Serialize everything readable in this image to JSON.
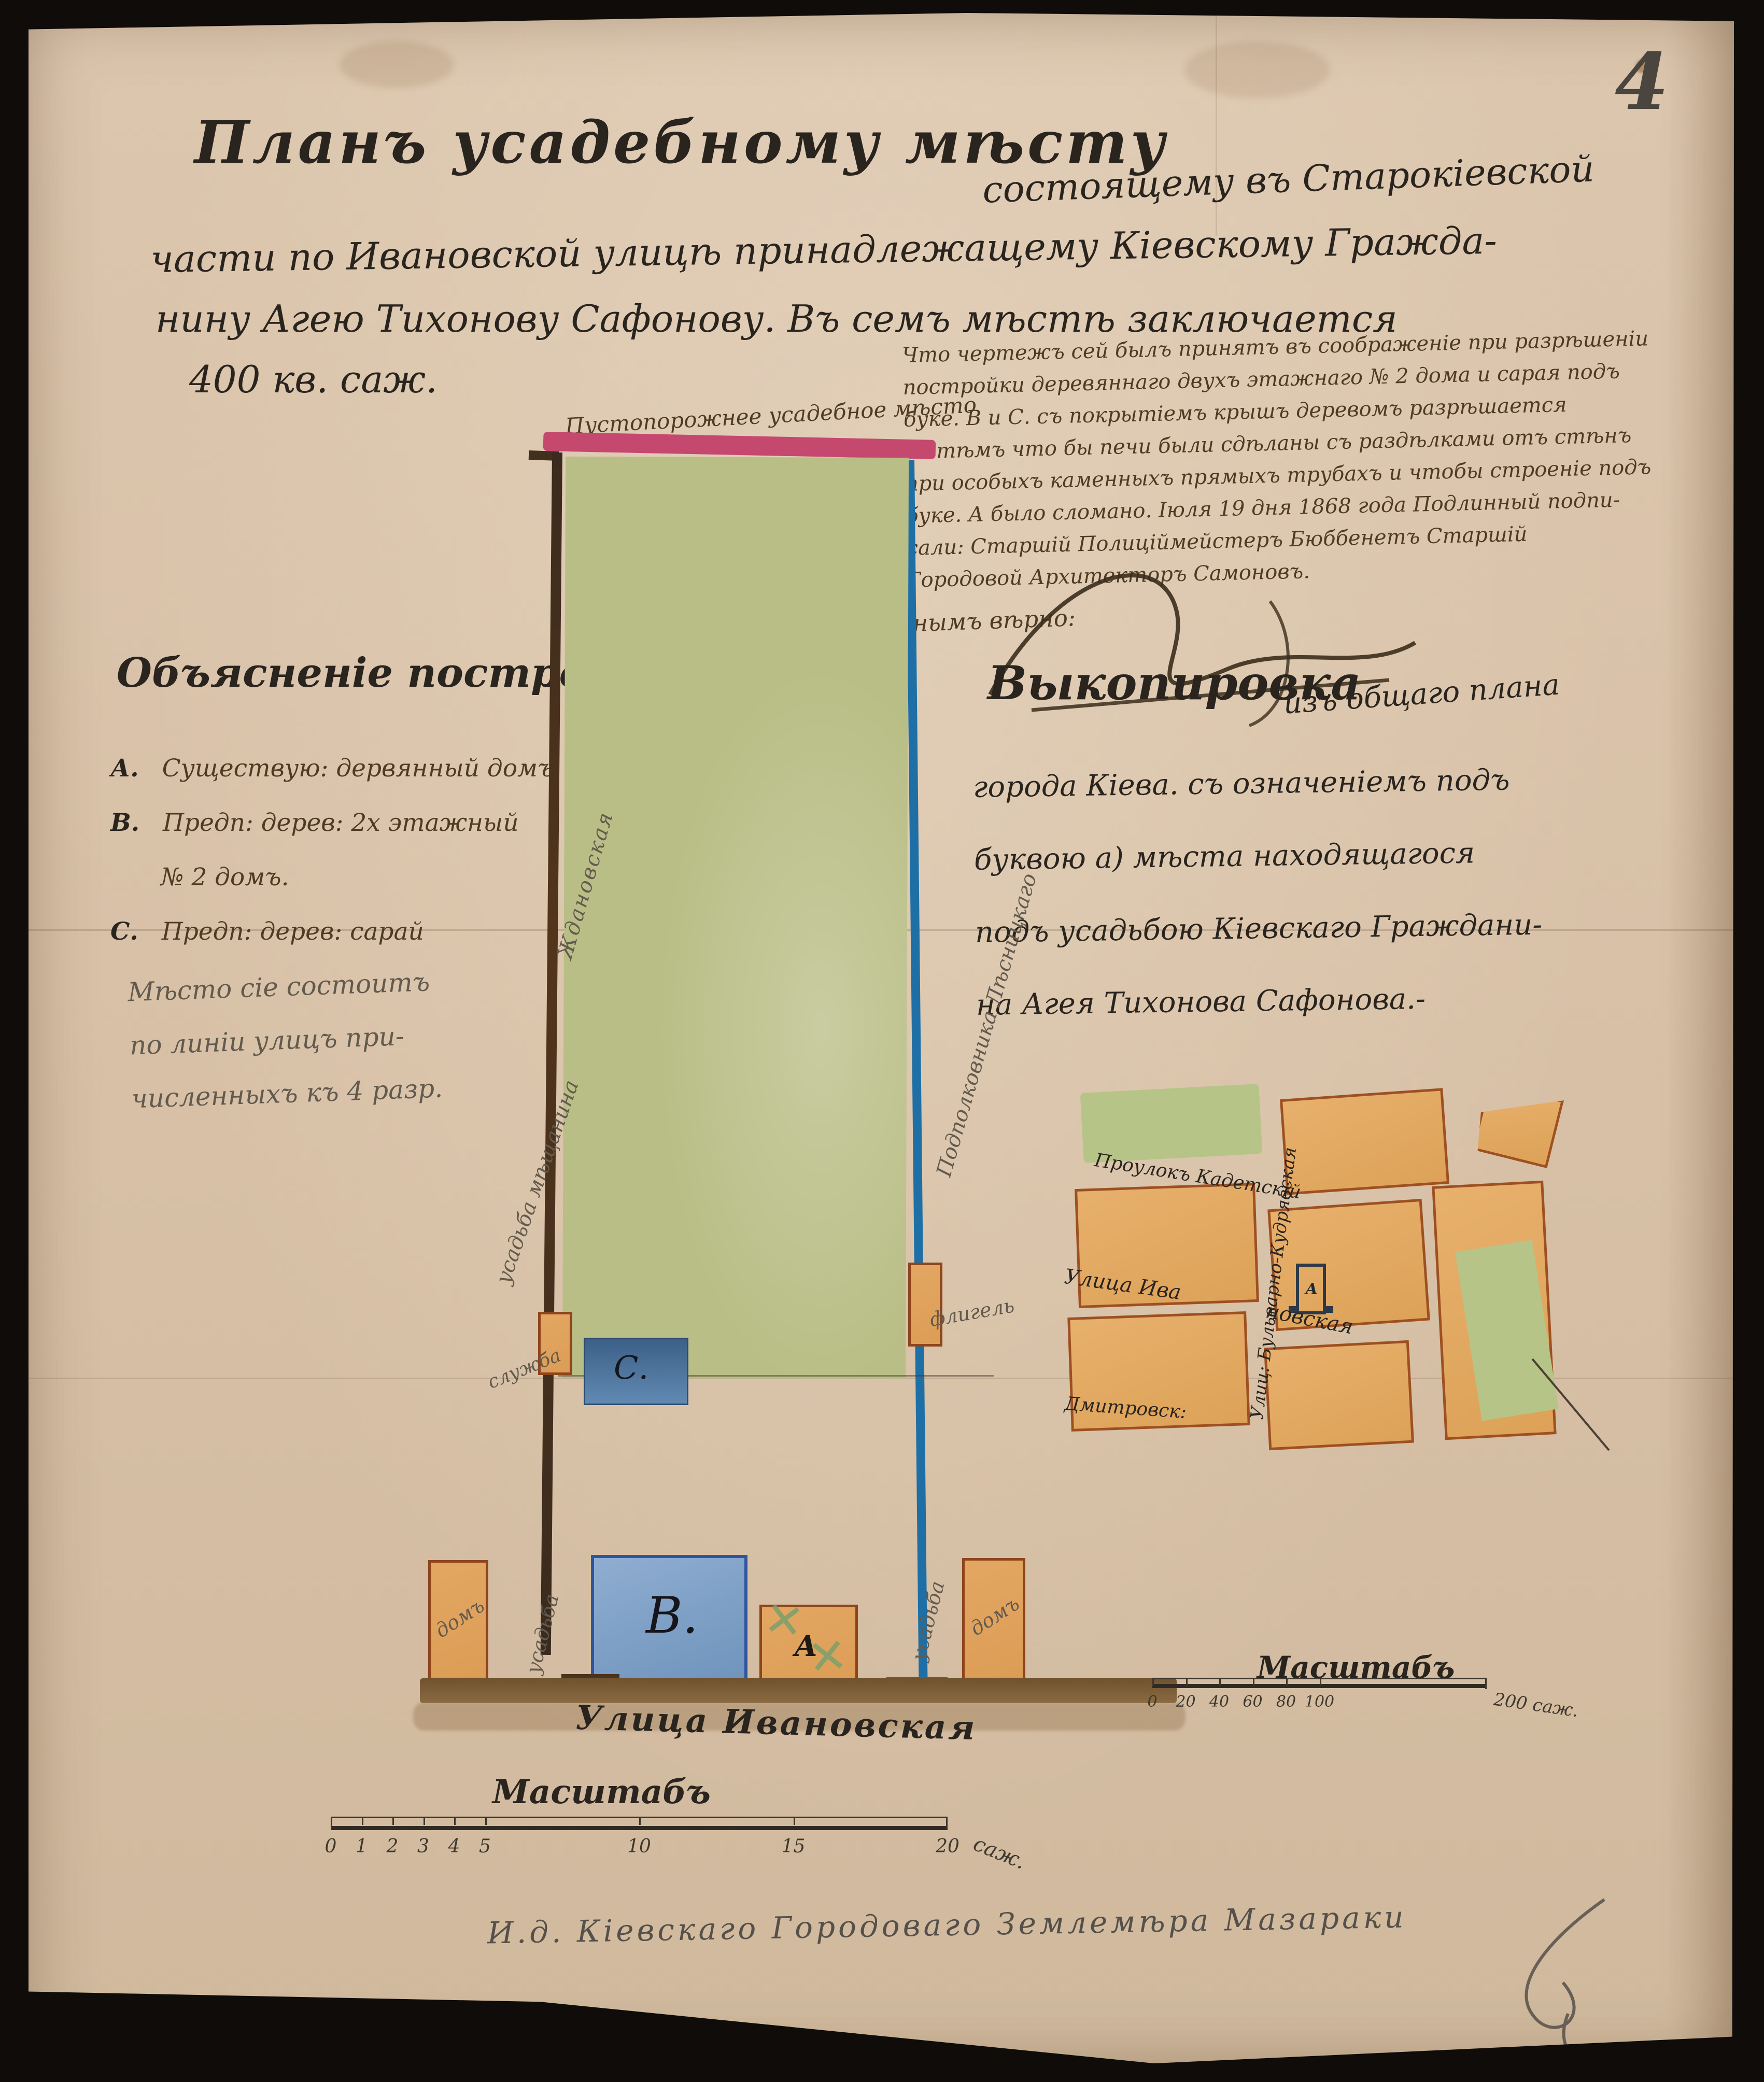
{
  "page_number": "4",
  "title": {
    "main": "Планъ усадебному мѣсту",
    "cont": "состоящему въ Старокіевской",
    "line2": "части по Ивановской улицѣ принадлежащему Кіевскому Гражда-",
    "line3": "нину Агею Тихонову Сафонову. Въ семъ мѣстѣ заключается",
    "area": "400 кв. саж."
  },
  "resolution_note": {
    "lines": [
      "Что чертежъ сей былъ принятъ въ соображеніе при разрѣшеніи",
      "постройки деревяннаго двухъ этажнаго № 2 дома и сарая подъ",
      "буке. В и С. съ покрытіемъ крышъ деревомъ разрѣшается",
      "съ тѣмъ что бы печи были сдѣланы съ раздѣлками отъ стѣнъ",
      "при особыхъ каменныхъ прямыхъ трубахъ и чтобы строеніе подъ",
      "буке. А было сломано. Іюля 19 дня 1868 года Подлинный подпи-",
      "сали: Старшій Полиціймейстеръ Бюббенетъ Старшій",
      "Городовой Архитекторъ Самоновъ."
    ]
  },
  "certification": {
    "label": "Съ подлиннымъ вѣрно:"
  },
  "excerpt": {
    "heading": "Выкопировка",
    "heading_cont": "изъ общаго плана",
    "lines": [
      "города Кіева. съ означеніемъ подъ",
      "буквою а) мѣста находящагося",
      "подъ усадьбою Кіевскаго Граждани-",
      "на Агея Тихонова Сафонова.-"
    ]
  },
  "legend": {
    "heading": "Объясненіе построекъ",
    "items": [
      {
        "letter": "А.",
        "text": "Существую: дервянный домъ"
      },
      {
        "letter": "В.",
        "text": "Предп: дерев: 2х этажный",
        "text2": "№ 2 домъ."
      },
      {
        "letter": "С.",
        "text": "Предп: дерев: сарай"
      }
    ],
    "pencil_note": [
      "Мѣсто сіе состоитъ",
      "по линіи улицъ при-",
      "численныхъ къ 4 разр."
    ]
  },
  "plan": {
    "top_label": "Пустопорожнее усадебное мѣсто",
    "street_label": "Улица Ивановская",
    "building_b": "В.",
    "building_a": "А",
    "building_c": "С.",
    "house_left": "домъ",
    "house_right": "домъ",
    "outbuilding_left": "служба",
    "outbuilding_right": "флигель",
    "side_left_upper": "Ждановская",
    "side_left_lower": "усадьба мѣщанина",
    "side_left_bottom": "усадьба",
    "side_right": "Подполковника Лѣсницкаго",
    "side_right_bottom": "усадьба"
  },
  "inset_map": {
    "street_top": "Проулокъ Кадетскій",
    "street_mid_1": "Улица Ива",
    "street_mid_2": "новская",
    "street_vertical": "Улиц: Бульварно-Кудрявская",
    "street_bottom": "Дмитровск:",
    "marker": "А"
  },
  "scale_main": {
    "title": "Масштабъ",
    "ticks": [
      "0",
      "1",
      "2",
      "3",
      "4",
      "5",
      "10",
      "15",
      "20"
    ],
    "unit": "саж."
  },
  "scale_inset": {
    "title": "Масштабъ",
    "ticks": [
      "0",
      "20",
      "40",
      "60",
      "80",
      "100"
    ],
    "end_label": "200 саж."
  },
  "surveyor": "И.д. Кіевскаго Городоваго Землемѣра Мазараки",
  "colors": {
    "paper": "#d9c2a9",
    "ink": "#2a241e",
    "brown_ink": "#4f3a24",
    "pencil": "#635a4e",
    "pink_border": "#c5486e",
    "blue_border": "#1e6fa5",
    "green_plot": "#b9be86",
    "orange_building": "#e0a45f",
    "blue_building": "#7fa0c6"
  }
}
